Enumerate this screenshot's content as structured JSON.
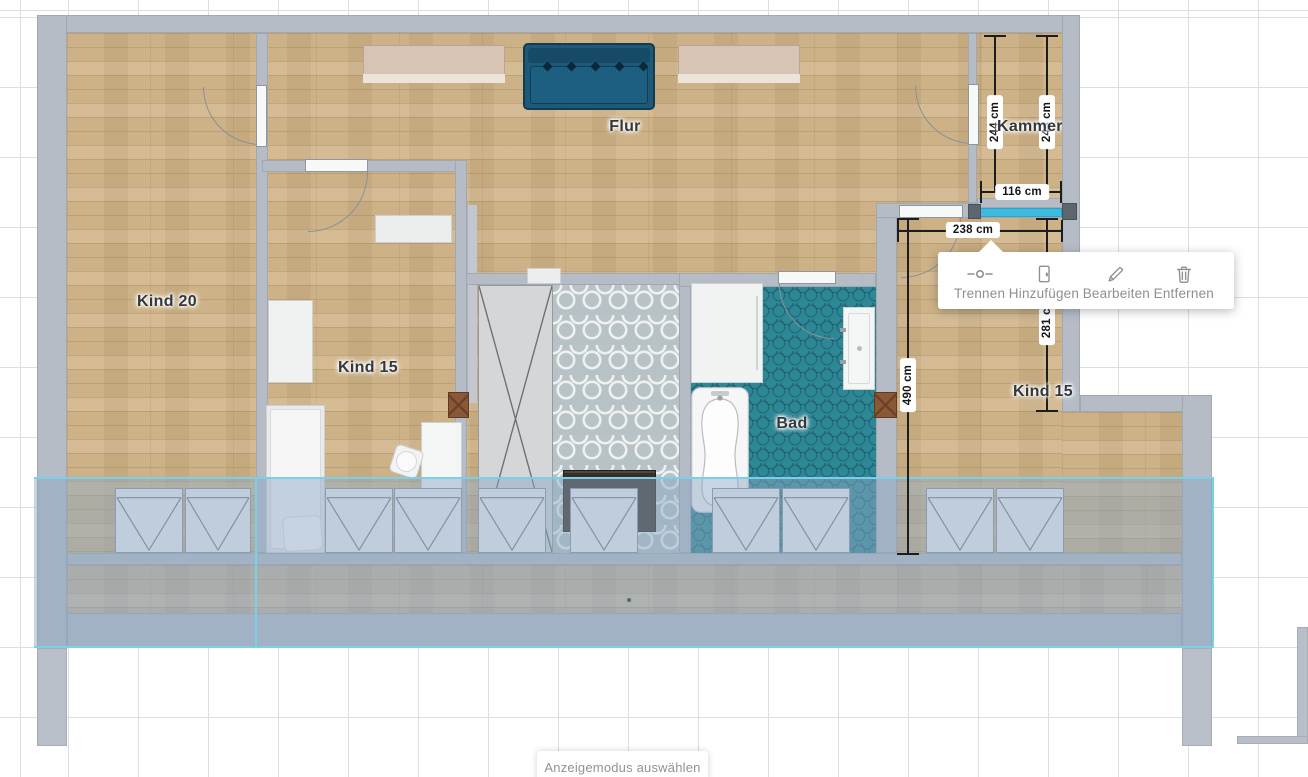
{
  "app": {
    "bottom_bar_label": "Anzeigemodus auswählen"
  },
  "rooms": {
    "kind20": {
      "label": "Kind 20"
    },
    "kind15_mid": {
      "label": "Kind 15"
    },
    "flur": {
      "label": "Flur"
    },
    "kammer": {
      "label": "Kammer"
    },
    "bad": {
      "label": "Bad"
    },
    "kind15_right": {
      "label": "Kind 15"
    }
  },
  "dimensions": {
    "kammer_height_left": "244 cm",
    "kammer_height_right": "244 cm",
    "kammer_width": "116 cm",
    "selected_wall_length": "238 cm",
    "kind15_right_upper_depth": "281 cm",
    "kind15_right_depth": "490 cm"
  },
  "wall_popup": {
    "items": [
      {
        "id": "trennen",
        "label": "Trennen",
        "icon": "split-wall-icon"
      },
      {
        "id": "hinzufuegen",
        "label": "Hinzufügen",
        "icon": "door-icon"
      },
      {
        "id": "bearbeiten",
        "label": "Bearbeiten",
        "icon": "pencil-icon"
      },
      {
        "id": "entfernen",
        "label": "Entfernen",
        "icon": "trash-icon"
      }
    ]
  },
  "colors": {
    "selected_wall": "#3dbadd",
    "roof_overlay_line": "#7ad0e8",
    "wall": "#b6bcc6",
    "wood_floor": "#cdb287",
    "bath_tile": "#2e8795",
    "popup_text": "#8b9095"
  }
}
